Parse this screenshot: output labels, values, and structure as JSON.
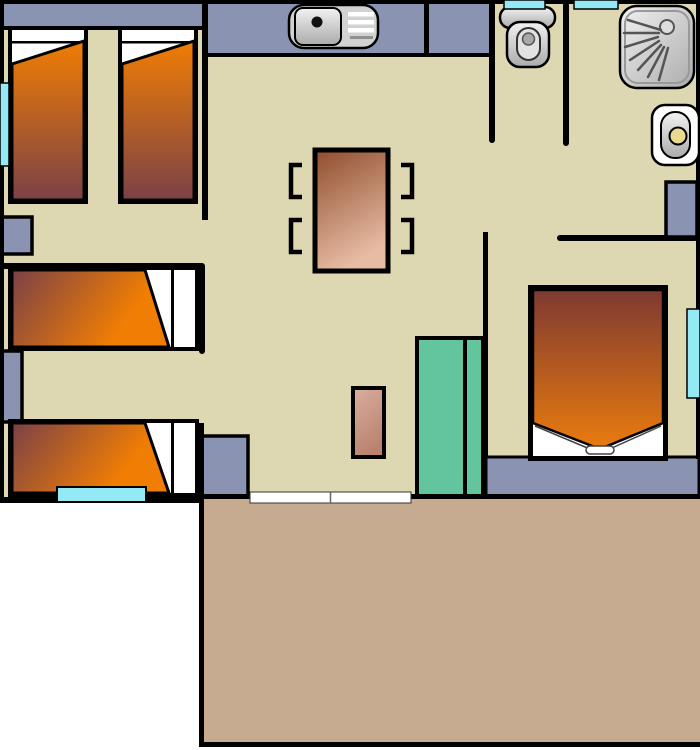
{
  "diagram": {
    "type": "floor-plan",
    "objects": [
      "single-bed",
      "single-bed",
      "single-bed",
      "single-bed",
      "double-bed",
      "kitchen-sink",
      "toilet",
      "shower",
      "washbasin",
      "dining-table",
      "chair",
      "chair",
      "chair",
      "chair",
      "wardrobe",
      "nightstand",
      "cabinet",
      "window",
      "terrace",
      "sliding-door"
    ]
  },
  "colors": {
    "outline_black": "#000000",
    "wall_blue": "#8A93B2",
    "floor_beige": "#DDD8B2",
    "terrace_tan": "#C7AB90",
    "teal_green": "#63C59D",
    "window_cyan": "#93E9F4",
    "bed_orange": "#F07D04",
    "bed_maroon": "#7B4147",
    "double_bed_dark": "#7E3931",
    "double_bed_orange": "#EA7B0E",
    "table_dark": "#8F4C2C",
    "table_light": "#E7BCA4",
    "rug_light": "#DCAF9F",
    "rug_dark": "#B9836F",
    "fixture_light": "#F2F2F2",
    "fixture_dark": "#ABABAB",
    "fixture_mid": "#D2D2D2",
    "seat_gray": "#E2E2E2",
    "drain_yellow": "#EAD98E",
    "door_white": "#FFFFFF"
  }
}
